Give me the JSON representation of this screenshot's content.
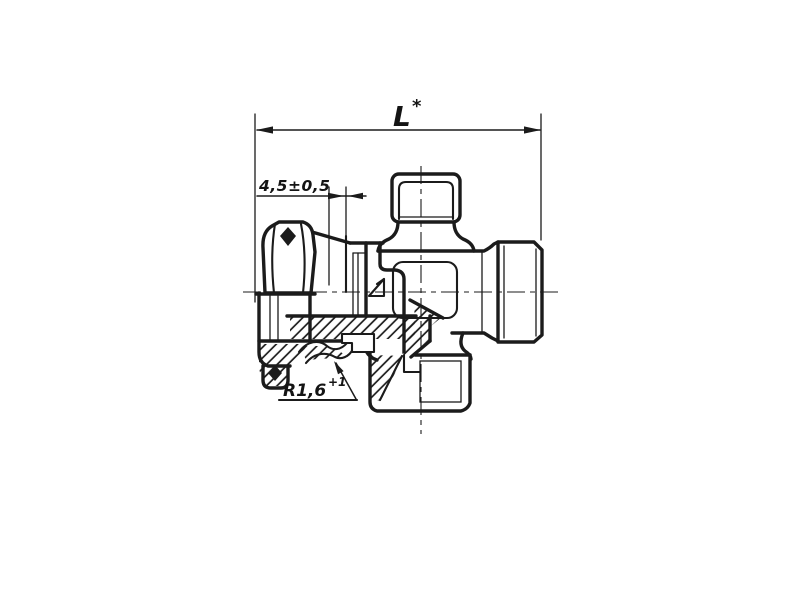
{
  "canvas": {
    "background": "#ffffff",
    "ink_color": "#1b1b1b"
  },
  "drawing": {
    "view": "sectional view of cross pipe fitting with union nut",
    "dimensions": {
      "length": {
        "label": "L",
        "sup": "*"
      },
      "offset": {
        "label": "4,5±0,5"
      },
      "radius": {
        "label": "R1,6",
        "sup": "+1"
      }
    }
  }
}
